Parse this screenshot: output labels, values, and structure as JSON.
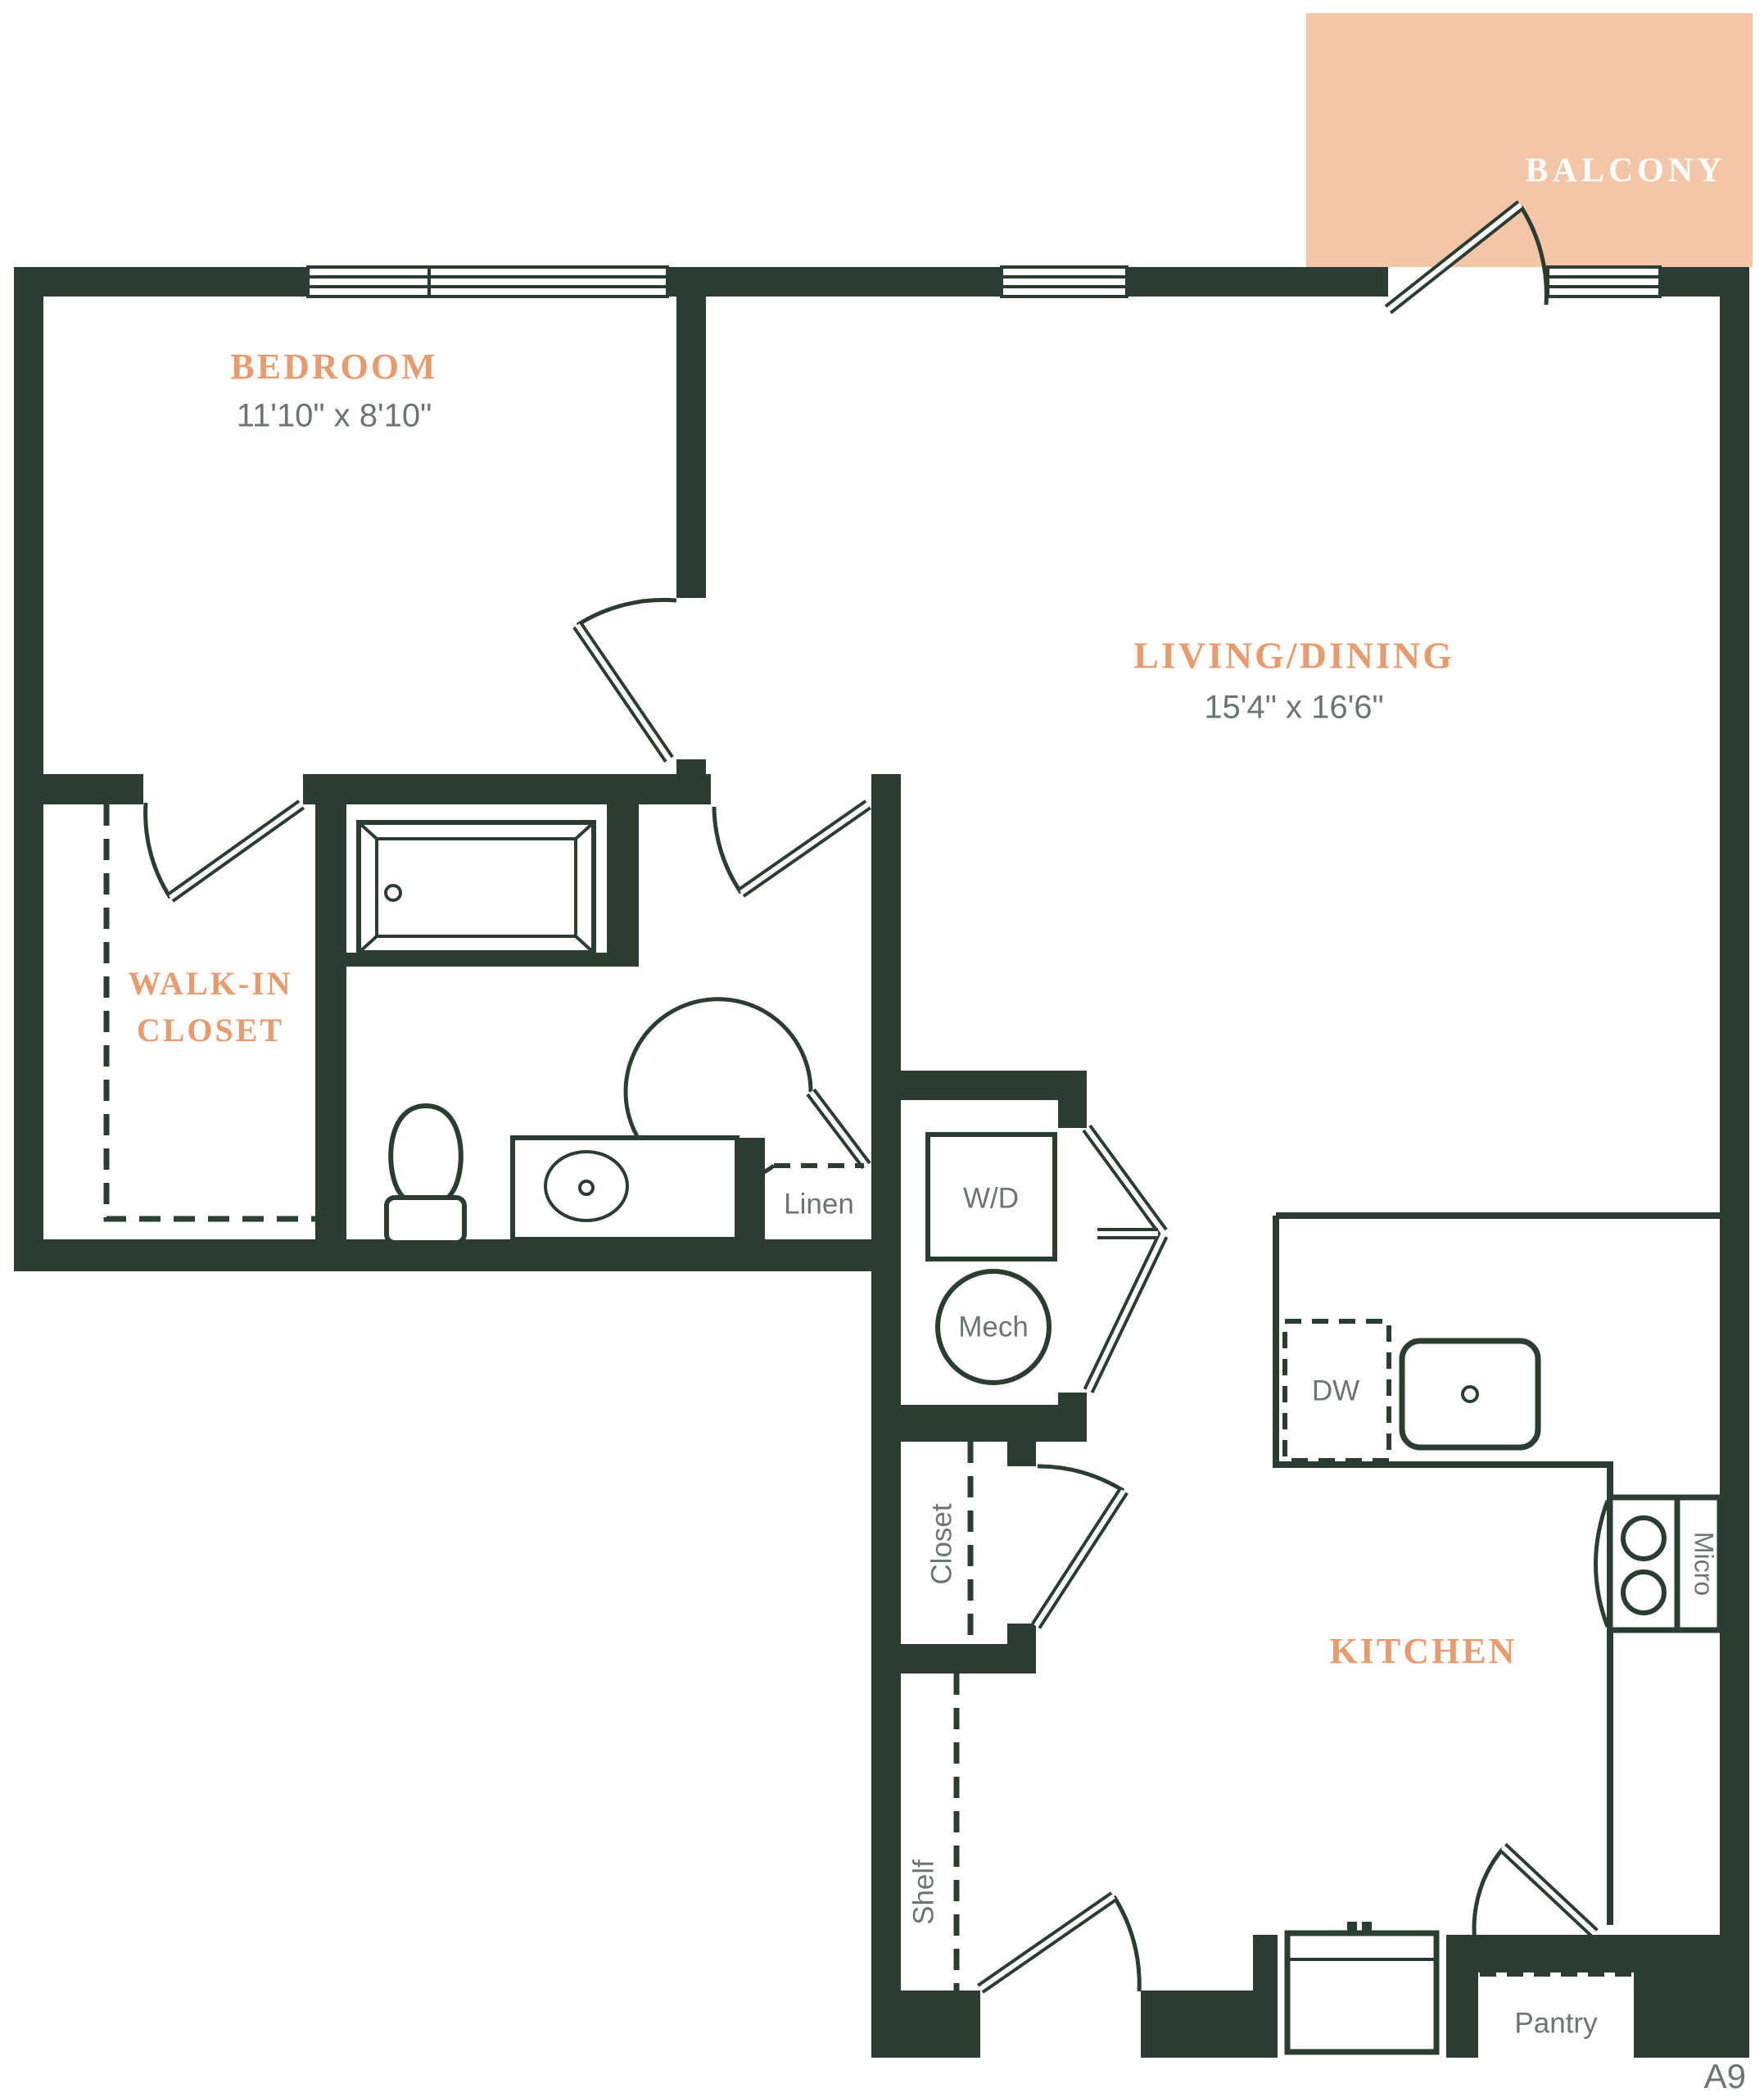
{
  "unit_label": "A9",
  "colors": {
    "wall_green": "#2b3d31",
    "accent_orange": "#e89b6f",
    "balcony_peach": "#f2c6a7",
    "text_gray": "#6d7570",
    "background": "#ffffff"
  },
  "balcony": {
    "label": "BALCONY"
  },
  "rooms": {
    "bedroom": {
      "label": "BEDROOM",
      "dimensions": "11'10\" x 8'10\""
    },
    "living_dining": {
      "label": "LIVING/DINING",
      "dimensions": "15'4\" x 16'6\""
    },
    "walk_in_closet": {
      "label_line1": "WALK-IN",
      "label_line2": "CLOSET"
    },
    "kitchen": {
      "label": "KITCHEN"
    }
  },
  "fixtures": {
    "linen": "Linen",
    "washer_dryer": "W/D",
    "mechanical": "Mech",
    "dishwasher": "DW",
    "hall_closet": "Closet",
    "shelf": "Shelf",
    "microwave": "Micro",
    "pantry": "Pantry"
  }
}
